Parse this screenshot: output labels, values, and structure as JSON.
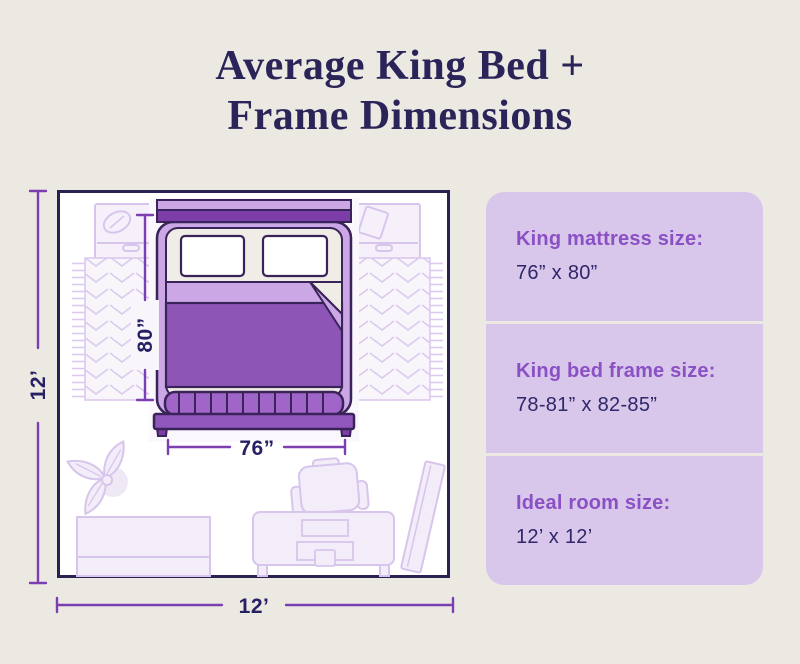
{
  "title": {
    "line1": "Average King Bed +",
    "line2": "Frame Dimensions"
  },
  "room": {
    "width_label": "12’",
    "height_label": "12’",
    "mattress_width_label": "76”",
    "mattress_length_label": "80”"
  },
  "panel": {
    "items": [
      {
        "label": "King mattress size:",
        "value": "76” x 80”"
      },
      {
        "label": "King bed frame size:",
        "value": "78-81” x 82-85”"
      },
      {
        "label": "Ideal room size:",
        "value": "12’ x 12’"
      }
    ]
  },
  "colors": {
    "background": "#ECE9E3",
    "title_navy": "#2A2458",
    "panel_bg": "#D8C7EB",
    "panel_heading_purple": "#8A50C4",
    "value_navy": "#2E2768",
    "dimension_line_purple": "#7C3FB2",
    "duvet_purple": "#8C55B6",
    "bed_frame_light_purple": "#CBA7E6",
    "furniture_outline_lavender": "#D8C5EC"
  }
}
